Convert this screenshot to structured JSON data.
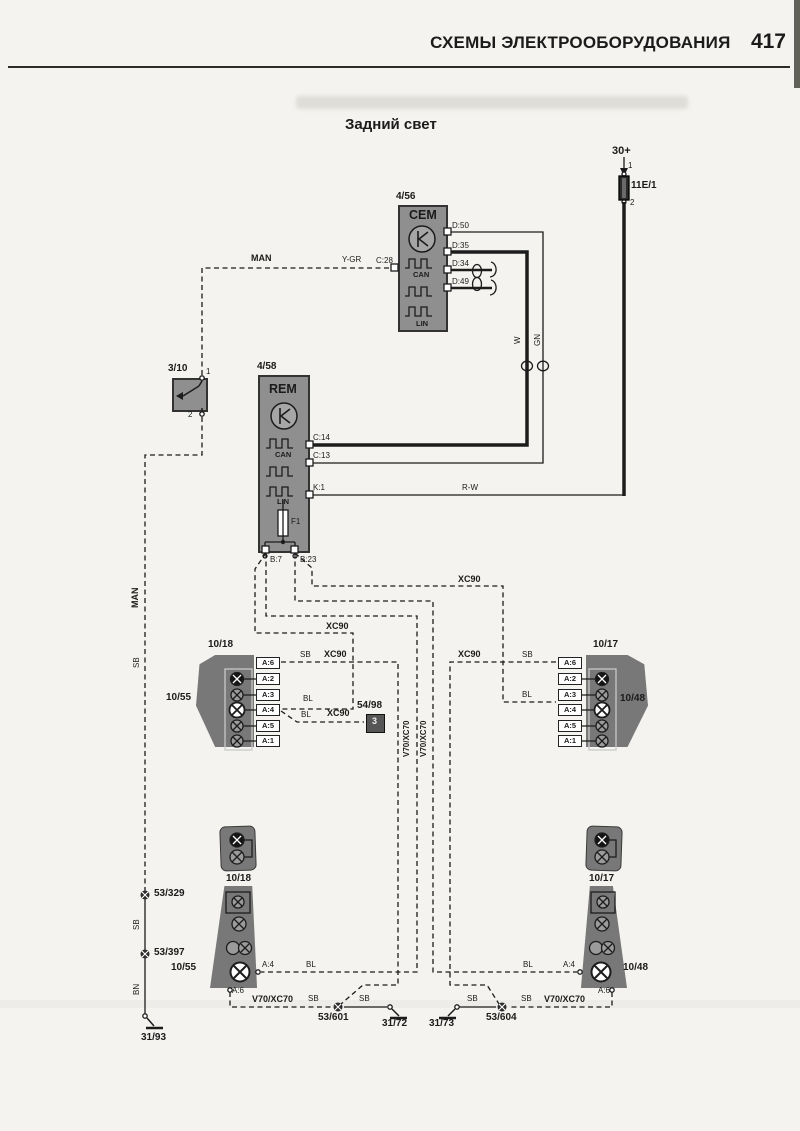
{
  "page": {
    "header": "СХЕМЫ ЭЛЕКТРООБОРУДОВАНИЯ",
    "number": "417",
    "title": "Задний свет"
  },
  "connectors": {
    "rows_y": [
      657,
      673,
      689,
      704,
      720,
      735
    ],
    "columns": [
      {
        "name": "connector-10-18",
        "x": 256,
        "pins": [
          "A:6",
          "A:2",
          "A:3",
          "A:4",
          "A:5",
          "A:1"
        ]
      },
      {
        "name": "connector-10-17",
        "x": 558,
        "pins": [
          "A:6",
          "A:2",
          "A:3",
          "A:4",
          "A:5",
          "A:1"
        ]
      }
    ]
  },
  "labels": [
    {
      "n": "terminal-30-label",
      "t": "30+",
      "x": 612,
      "y": 146,
      "c": "b s11"
    },
    {
      "n": "fuse-pin1-label",
      "t": "1",
      "x": 628,
      "y": 162,
      "c": "s8"
    },
    {
      "n": "fuse-label",
      "t": "11E/1",
      "x": 631,
      "y": 181,
      "c": "b s10"
    },
    {
      "n": "fuse-pin2-label",
      "t": "2",
      "x": 630,
      "y": 199,
      "c": "s8"
    },
    {
      "n": "cem-id-label",
      "t": "4/56",
      "x": 396,
      "y": 192,
      "c": "b s10"
    },
    {
      "n": "cem-name-label",
      "t": "CEM",
      "x": 409,
      "y": 209,
      "c": "b s12"
    },
    {
      "n": "cem-can-label",
      "t": "CAN",
      "x": 413,
      "y": 271,
      "c": "b s7"
    },
    {
      "n": "cem-lin-label",
      "t": "LIN",
      "x": 416,
      "y": 320,
      "c": "b s7"
    },
    {
      "n": "cem-pin-d50",
      "t": "D:50",
      "x": 452,
      "y": 222,
      "c": "s8"
    },
    {
      "n": "cem-pin-d35",
      "t": "D:35",
      "x": 452,
      "y": 242,
      "c": "s8"
    },
    {
      "n": "cem-pin-d34",
      "t": "D:34",
      "x": 452,
      "y": 260,
      "c": "s8"
    },
    {
      "n": "cem-pin-d49",
      "t": "D:49",
      "x": 452,
      "y": 278,
      "c": "s8"
    },
    {
      "n": "cem-pin-c28",
      "t": "C:28",
      "x": 376,
      "y": 257,
      "c": "s8"
    },
    {
      "n": "wire-label-ygr",
      "t": "Y-GR",
      "x": 342,
      "y": 256,
      "c": "s8"
    },
    {
      "n": "wire-label-man",
      "t": "MAN",
      "x": 251,
      "y": 254,
      "c": "b s9"
    },
    {
      "n": "wire-label-w",
      "t": "W",
      "x": 514,
      "y": 344,
      "c": "s8 rot"
    },
    {
      "n": "wire-label-gn",
      "t": "GN",
      "x": 534,
      "y": 346,
      "c": "s8 rot"
    },
    {
      "n": "switch-id-label",
      "t": "3/10",
      "x": 168,
      "y": 364,
      "c": "b s10"
    },
    {
      "n": "switch-pin1-label",
      "t": "1",
      "x": 206,
      "y": 368,
      "c": "s8"
    },
    {
      "n": "switch-pin2-label",
      "t": "2",
      "x": 188,
      "y": 411,
      "c": "s8"
    },
    {
      "n": "rem-id-label",
      "t": "4/58",
      "x": 257,
      "y": 362,
      "c": "b s10"
    },
    {
      "n": "rem-name-label",
      "t": "REM",
      "x": 269,
      "y": 383,
      "c": "b s12"
    },
    {
      "n": "rem-can-label",
      "t": "CAN",
      "x": 275,
      "y": 451,
      "c": "b s7"
    },
    {
      "n": "rem-lin-label",
      "t": "LIN",
      "x": 277,
      "y": 498,
      "c": "b s7"
    },
    {
      "n": "rem-f1-label",
      "t": "F1",
      "x": 291,
      "y": 518,
      "c": "s8"
    },
    {
      "n": "rem-pin-c14",
      "t": "C:14",
      "x": 313,
      "y": 434,
      "c": "s8"
    },
    {
      "n": "rem-pin-c13",
      "t": "C:13",
      "x": 313,
      "y": 452,
      "c": "s8"
    },
    {
      "n": "rem-pin-k1",
      "t": "K:1",
      "x": 313,
      "y": 484,
      "c": "s8"
    },
    {
      "n": "wire-label-rw",
      "t": "R-W",
      "x": 462,
      "y": 484,
      "c": "s8"
    },
    {
      "n": "rem-pin-b7",
      "t": "B:7",
      "x": 270,
      "y": 556,
      "c": "s8"
    },
    {
      "n": "rem-pin-b23",
      "t": "B:23",
      "x": 300,
      "y": 556,
      "c": "s8"
    },
    {
      "n": "wire-label-man-2",
      "t": "MAN",
      "x": 131,
      "y": 608,
      "c": "b s9 rot"
    },
    {
      "n": "wire-label-sb-1",
      "t": "SB",
      "x": 133,
      "y": 668,
      "c": "s8 rot"
    },
    {
      "n": "wire-label-xc90-1",
      "t": "XC90",
      "x": 458,
      "y": 575,
      "c": "b s9"
    },
    {
      "n": "wire-label-xc90-2",
      "t": "XC90",
      "x": 326,
      "y": 622,
      "c": "b s9"
    },
    {
      "n": "wire-label-sb-2",
      "t": "SB",
      "x": 300,
      "y": 651,
      "c": "s8"
    },
    {
      "n": "wire-label-xc90-3",
      "t": "XC90",
      "x": 324,
      "y": 650,
      "c": "b s9"
    },
    {
      "n": "wire-label-xc90-4",
      "t": "XC90",
      "x": 458,
      "y": 650,
      "c": "b s9"
    },
    {
      "n": "wire-label-sb-3",
      "t": "SB",
      "x": 522,
      "y": 651,
      "c": "s8"
    },
    {
      "n": "wire-label-bl-1",
      "t": "BL",
      "x": 303,
      "y": 695,
      "c": "s8"
    },
    {
      "n": "wire-label-bl-2",
      "t": "BL",
      "x": 522,
      "y": 691,
      "c": "s8"
    },
    {
      "n": "wire-label-bl-3",
      "t": "BL",
      "x": 301,
      "y": 711,
      "c": "s8"
    },
    {
      "n": "wire-label-xc90-5",
      "t": "XC90",
      "x": 327,
      "y": 709,
      "c": "b s9"
    },
    {
      "n": "trailer-id-label",
      "t": "54/98",
      "x": 357,
      "y": 701,
      "c": "b s10"
    },
    {
      "n": "trailer-pin3-label",
      "t": "3",
      "x": 372,
      "y": 717,
      "c": "b s9 wt"
    },
    {
      "n": "left-connector-label",
      "t": "10/18",
      "x": 208,
      "y": 640,
      "c": "b s10"
    },
    {
      "n": "left-lamp-label",
      "t": "10/55",
      "x": 166,
      "y": 693,
      "c": "b s10"
    },
    {
      "n": "right-connector-label",
      "t": "10/17",
      "x": 593,
      "y": 640,
      "c": "b s10"
    },
    {
      "n": "right-lamp-label",
      "t": "10/48",
      "x": 620,
      "y": 694,
      "c": "b s10"
    },
    {
      "n": "wire-label-v70-1",
      "t": "V70/XC70",
      "x": 403,
      "y": 757,
      "c": "b s8 rot"
    },
    {
      "n": "wire-label-v70-2",
      "t": "V70/XC70",
      "x": 420,
      "y": 757,
      "c": "b s8 rot"
    },
    {
      "n": "splice-53-329-label",
      "t": "53/329",
      "x": 154,
      "y": 889,
      "c": "b s10"
    },
    {
      "n": "wire-label-sb-4",
      "t": "SB",
      "x": 133,
      "y": 930,
      "c": "s8 rot"
    },
    {
      "n": "splice-53-397-label",
      "t": "53/397",
      "x": 154,
      "y": 948,
      "c": "b s10"
    },
    {
      "n": "wire-label-bn",
      "t": "BN",
      "x": 133,
      "y": 995,
      "c": "s8 rot"
    },
    {
      "n": "ground-31-93-label",
      "t": "31/93",
      "x": 141,
      "y": 1033,
      "c": "b s10"
    },
    {
      "n": "bottom-left-connector-label",
      "t": "10/18",
      "x": 226,
      "y": 874,
      "c": "b s10"
    },
    {
      "n": "bottom-right-connector-label",
      "t": "10/17",
      "x": 589,
      "y": 874,
      "c": "b s10"
    },
    {
      "n": "bottom-left-lamp-label",
      "t": "10/55",
      "x": 171,
      "y": 963,
      "c": "b s10"
    },
    {
      "n": "bottom-right-lamp-label",
      "t": "10/48",
      "x": 623,
      "y": 963,
      "c": "b s10"
    },
    {
      "n": "pin-a4-left-label",
      "t": "A:4",
      "x": 262,
      "y": 961,
      "c": "s8"
    },
    {
      "n": "pin-a6-left-label",
      "t": "A:6",
      "x": 232,
      "y": 987,
      "c": "s8"
    },
    {
      "n": "pin-a4-right-label",
      "t": "A:4",
      "x": 563,
      "y": 961,
      "c": "s8"
    },
    {
      "n": "pin-a6-right-label",
      "t": "A:6",
      "x": 598,
      "y": 987,
      "c": "s8"
    },
    {
      "n": "wire-label-bl-4",
      "t": "BL",
      "x": 306,
      "y": 961,
      "c": "s8"
    },
    {
      "n": "wire-label-bl-5",
      "t": "BL",
      "x": 523,
      "y": 961,
      "c": "s8"
    },
    {
      "n": "wire-label-v70-3",
      "t": "V70/XC70",
      "x": 252,
      "y": 995,
      "c": "b s9"
    },
    {
      "n": "wire-label-sb-5",
      "t": "SB",
      "x": 308,
      "y": 995,
      "c": "s8"
    },
    {
      "n": "splice-53-601-label",
      "t": "53/601",
      "x": 318,
      "y": 1013,
      "c": "b s10"
    },
    {
      "n": "wire-label-sb-6",
      "t": "SB",
      "x": 359,
      "y": 995,
      "c": "s8"
    },
    {
      "n": "ground-31-72-label",
      "t": "31/72",
      "x": 382,
      "y": 1019,
      "c": "b s10"
    },
    {
      "n": "ground-31-73-label",
      "t": "31/73",
      "x": 429,
      "y": 1019,
      "c": "b s10"
    },
    {
      "n": "wire-label-sb-7",
      "t": "SB",
      "x": 467,
      "y": 995,
      "c": "s8"
    },
    {
      "n": "splice-53-604-label",
      "t": "53/604",
      "x": 486,
      "y": 1013,
      "c": "b s10"
    },
    {
      "n": "wire-label-sb-8",
      "t": "SB",
      "x": 521,
      "y": 995,
      "c": "s8"
    },
    {
      "n": "wire-label-v70-4",
      "t": "V70/XC70",
      "x": 544,
      "y": 995,
      "c": "b s9"
    }
  ]
}
